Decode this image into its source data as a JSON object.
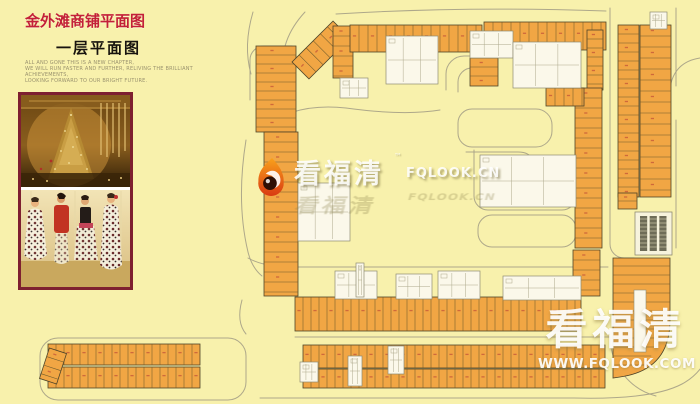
{
  "page": {
    "width": 700,
    "height": 404,
    "bg": "#F8F1AC"
  },
  "header": {
    "title": "金外滩商铺平面图",
    "subtitle": "一层平面图",
    "title_color": "#C32038",
    "tagline": [
      "ALL AND GONE THIS IS A NEW CHAPTER,",
      "WE WILL RUN FASTER AND FURTHER, RELIVING THE BRILLIANT ACHIEVEMENTS,",
      "LOOKING FORWARD TO OUR BRIGHT FUTURE."
    ]
  },
  "photo": {
    "frame_color": "#7E2030"
  },
  "watermarks": {
    "center": {
      "brand": "看福清",
      "tm": "™",
      "domain": "FQLOOK.CN"
    },
    "bottom_right": {
      "brand": "看福清",
      "domain": "WWW.FQLOOK.COM"
    }
  },
  "floorplan": {
    "colors": {
      "bg": "#F8F1AC",
      "shop": "#F1A644",
      "shop_stroke": "#4E4428",
      "divider": "#6E5B2B",
      "white": "#FBF8EA",
      "white_stroke": "#8F8C72",
      "detail": "#ADA98C",
      "road": "#A5A086",
      "parking_bar": "#56543F",
      "unit_mark": "#C05038"
    },
    "roads": [
      "M58,338 h170 a18,18 0 0 1 18,18 v26 a18,18 0 0 1 -18,18 h-170 a18,18 0 0 1 -18,-18 v-26 a18,18 0 0 1 18,-18 z",
      "M472,147 a14,14 0 0 1 -14,-14 v-10 a14,14 0 0 1 14,-14 h64 a16,16 0 0 1 16,16 v6 a16,16 0 0 1 -16,16 z",
      "M466,152 h52 q12,0 14,8",
      "M474,150 v46 a14,14 0 0 0 14,14 h74 a14,14 0 0 0 14,-14 v-40",
      "M492,215 h70 a14,14 0 0 1 14,14 v4 a14,14 0 0 1 -14,14 h-70 a14,14 0 0 1 -14,-14 v-4 a14,14 0 0 1 14,-14 z",
      "M610,8 v236 a14,14 0 0 0 14,14 h10",
      "M676,8 v78 m0,34 v128",
      "M248,258 q16,9 44,9 h316",
      "M295,337 h316",
      "M253,12 q-10,34 -2,62",
      "M305,12 q-26,28 -22,62",
      "M250,100 v-40 a14,14 0 0 1 14,-14 h28",
      "M246,140 q-10,62 2,112 q4,16 14,24",
      "M258,130 q36,-28 88,-22 q58,8 94,2",
      "M700,58 q-26,4 -30,30",
      "M446,90 v-16 a18,18 0 0 1 18,-18 h24",
      "M458,92 v-10 a14,14 0 0 1 14,-14 h16",
      "M260,398 h314 q78,2 108,-14 q28,-15 32,-52",
      "M610,338 a62,62 0 0 0 46,58",
      "M242,300 q-6,22 4,34",
      "M336,14 q130,-8 270,-3"
    ],
    "strips": [
      {
        "x": 256,
        "y": 46,
        "w": 40,
        "h": 86,
        "o": "v",
        "s": 9
      },
      {
        "x": 292,
        "y": 38,
        "w": 58,
        "h": 24,
        "o": "h",
        "s": 10,
        "a": -45
      },
      {
        "x": 333,
        "y": 26,
        "w": 20,
        "h": 52,
        "o": "v",
        "s": 10
      },
      {
        "x": 350,
        "y": 25,
        "w": 132,
        "h": 27,
        "o": "h",
        "s": 9
      },
      {
        "x": 484,
        "y": 22,
        "w": 122,
        "h": 28,
        "o": "h",
        "s": 9
      },
      {
        "x": 587,
        "y": 30,
        "w": 16,
        "h": 60,
        "o": "v",
        "s": 9
      },
      {
        "x": 618,
        "y": 25,
        "w": 21,
        "h": 172,
        "o": "v",
        "s": 9
      },
      {
        "x": 640,
        "y": 25,
        "w": 31,
        "h": 172,
        "o": "v",
        "s": 11
      },
      {
        "x": 575,
        "y": 88,
        "w": 27,
        "h": 160,
        "o": "v",
        "s": 10
      },
      {
        "x": 264,
        "y": 132,
        "w": 34,
        "h": 164,
        "o": "v",
        "s": 10
      },
      {
        "x": 295,
        "y": 297,
        "w": 286,
        "h": 34,
        "o": "h",
        "s": 8
      },
      {
        "x": 303,
        "y": 345,
        "w": 302,
        "h": 23,
        "o": "h",
        "s": 8
      },
      {
        "x": 303,
        "y": 369,
        "w": 302,
        "h": 19,
        "o": "h",
        "s": 8
      },
      {
        "x": 573,
        "y": 250,
        "w": 27,
        "h": 46,
        "o": "v",
        "s": 10
      },
      {
        "x": 48,
        "y": 344,
        "w": 152,
        "h": 21,
        "o": "h",
        "s": 8
      },
      {
        "x": 48,
        "y": 367,
        "w": 152,
        "h": 21,
        "o": "h",
        "s": 8
      },
      {
        "x": 618,
        "y": 193,
        "w": 19,
        "h": 16,
        "o": "v",
        "s": 8
      },
      {
        "x": 470,
        "y": 58,
        "w": 28,
        "h": 28,
        "o": "v",
        "s": 9
      },
      {
        "x": 546,
        "y": 88,
        "w": 38,
        "h": 18,
        "o": "h",
        "s": 9
      },
      {
        "x": 44,
        "y": 350,
        "w": 18,
        "h": 32,
        "o": "v",
        "s": 9,
        "a": 18
      }
    ],
    "whites": [
      {
        "x": 386,
        "y": 36,
        "w": 52,
        "h": 48
      },
      {
        "x": 470,
        "y": 31,
        "w": 43,
        "h": 27
      },
      {
        "x": 513,
        "y": 42,
        "w": 68,
        "h": 46
      },
      {
        "x": 480,
        "y": 155,
        "w": 96,
        "h": 52
      },
      {
        "x": 298,
        "y": 183,
        "w": 52,
        "h": 58
      },
      {
        "x": 335,
        "y": 271,
        "w": 42,
        "h": 28
      },
      {
        "x": 396,
        "y": 274,
        "w": 36,
        "h": 25
      },
      {
        "x": 438,
        "y": 271,
        "w": 42,
        "h": 28
      },
      {
        "x": 503,
        "y": 276,
        "w": 78,
        "h": 24
      },
      {
        "x": 650,
        "y": 12,
        "w": 17,
        "h": 17
      },
      {
        "x": 388,
        "y": 346,
        "w": 16,
        "h": 28
      },
      {
        "x": 356,
        "y": 263,
        "w": 8,
        "h": 34
      },
      {
        "x": 340,
        "y": 78,
        "w": 28,
        "h": 20
      },
      {
        "x": 300,
        "y": 362,
        "w": 18,
        "h": 20
      },
      {
        "x": 348,
        "y": 356,
        "w": 14,
        "h": 30
      }
    ],
    "parking": [
      {
        "x": 635,
        "y": 212,
        "w": 37,
        "h": 43,
        "g": 3
      }
    ],
    "lblock": {
      "x": 613,
      "y": 258,
      "w": 57,
      "h": 130,
      "col": {
        "x": 634,
        "y": 290,
        "w": 12,
        "h": 62
      }
    }
  }
}
